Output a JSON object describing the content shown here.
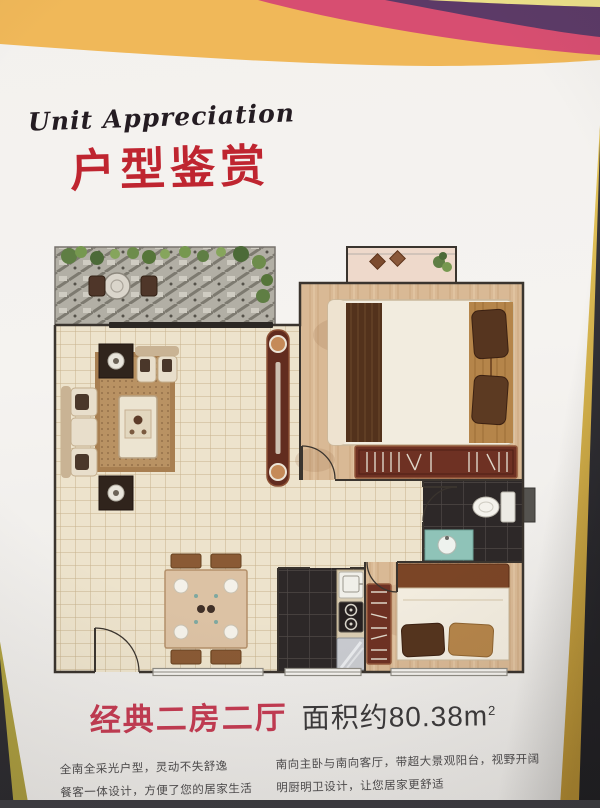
{
  "photo": {
    "wall_color": "#35343a",
    "frame_edge_color": "#d8b44a"
  },
  "banner": {
    "yellow": "#f0b859",
    "pink": "#d74e71",
    "purple": "#5c3a67",
    "pale_yellow": "#ece089"
  },
  "header": {
    "eyebrow": "Unit Appreciation",
    "title": "户型鉴赏",
    "title_color": "#bf2530"
  },
  "caption": {
    "unit_type": "经典二房二厅",
    "area_label": "面积约",
    "area_value": "80.38",
    "area_unit": "m",
    "area_exponent": "2",
    "unit_type_color": "#c43b52"
  },
  "features": {
    "left": [
      "全南全采光户型，灵动不失舒逸",
      "餐客一体设计，方便了您的居家生活"
    ],
    "right": [
      "南向主卧与南向客厅，带超大景观阳台，视野开阔",
      "明厨明卫设计，让您居家更舒适"
    ]
  }
}
